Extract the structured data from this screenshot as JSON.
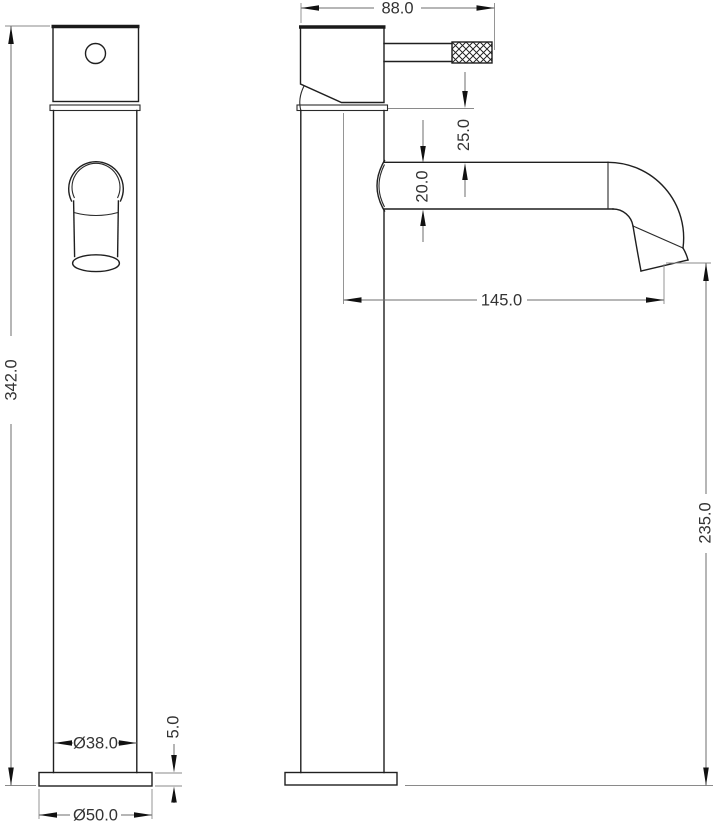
{
  "drawing": {
    "type": "technical-dimension-drawing",
    "subject": "Tall single-lever basin mixer tap — front and side elevations with dimensions",
    "background_color": "#ffffff",
    "object_line_color": "#1f1f1f",
    "dimension_line_color": "#6e6e6e",
    "text_color": "#333333",
    "views": {
      "front": {
        "name": "front elevation",
        "dimensions": {
          "overall_height": "342.0",
          "body_diameter": "Ø38.0",
          "base_diameter": "Ø50.0",
          "base_plate_height": "5.0"
        }
      },
      "side": {
        "name": "side elevation",
        "dimensions": {
          "head_and_handle_width": "88.0",
          "head_to_spout_gap": "25.0",
          "spout_tube_diameter": "20.0",
          "spout_reach": "145.0",
          "spout_outlet_height": "235.0"
        }
      }
    }
  }
}
